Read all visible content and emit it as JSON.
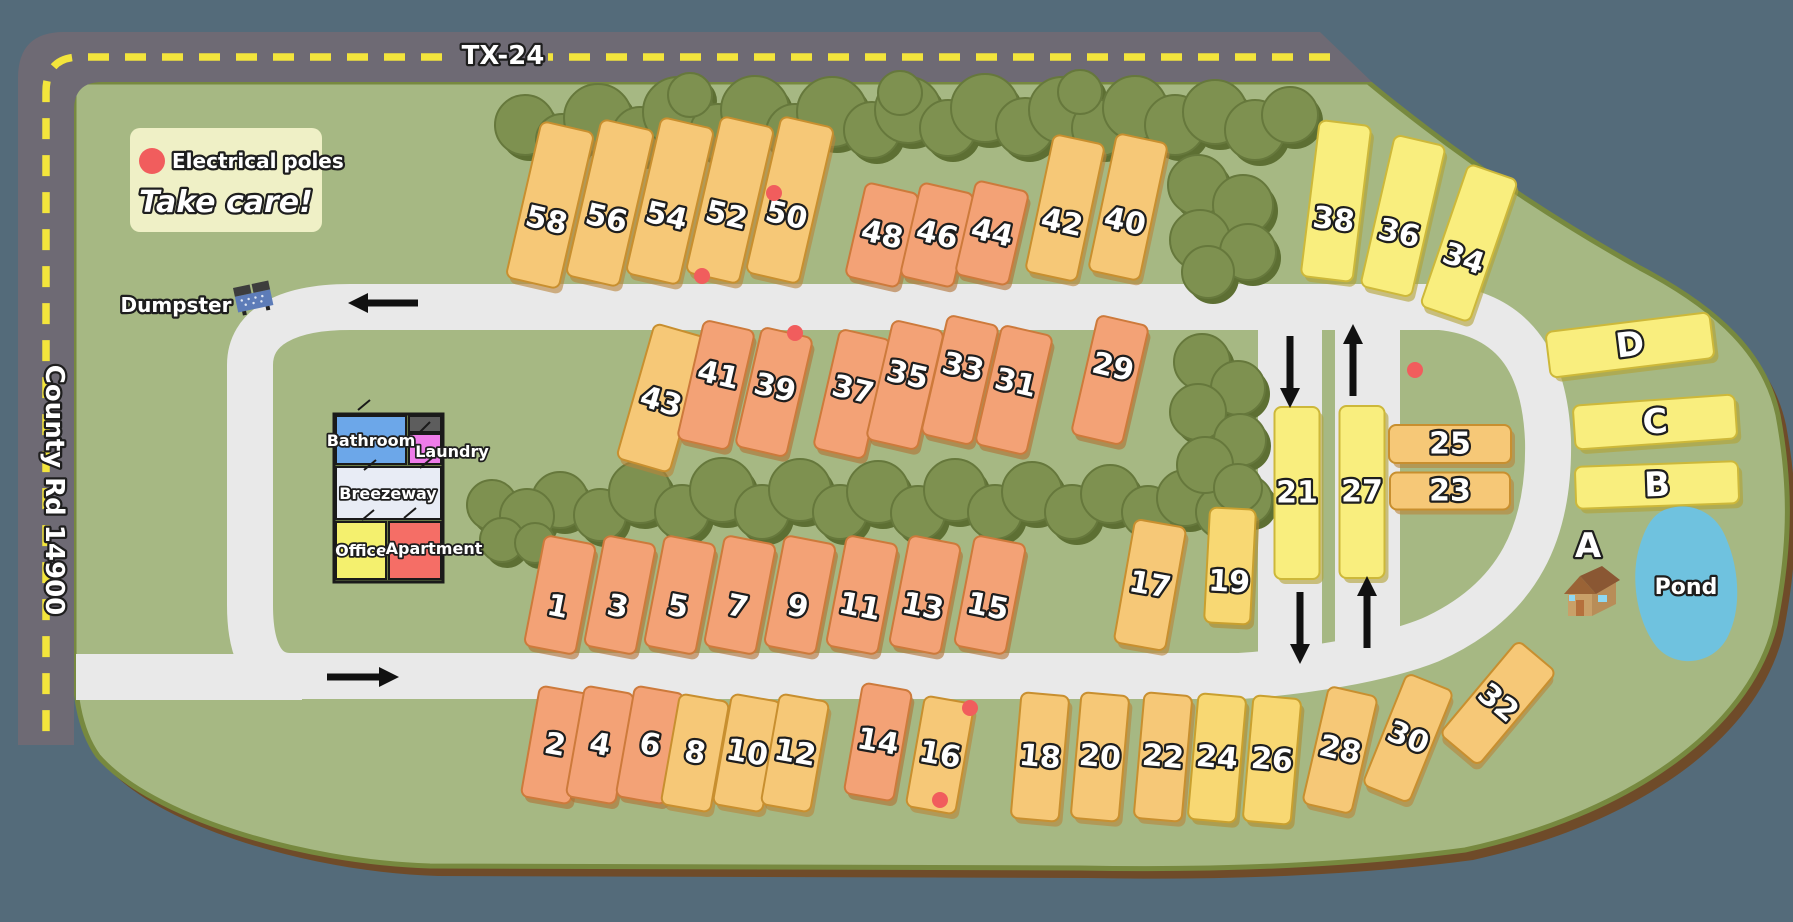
{
  "map": {
    "roads": {
      "highway": "TX-24",
      "county": "County Rd 14900"
    },
    "legend": {
      "marker": "Electrical poles",
      "warning": "Take care!"
    },
    "labels": {
      "dumpster": "Dumpster",
      "pond": "Pond",
      "cabin": "A"
    },
    "building": {
      "bathroom": "Bathroom",
      "laundry": "Laundry",
      "breezeway": "Breezeway",
      "office": "Office",
      "apartment": "Apartment"
    },
    "colors": {
      "outside": "#546b7a",
      "rim": "#6f4b29",
      "rim_edge": "#77893f",
      "grass": "#a6b883",
      "road_dark": "#6e6a74",
      "road_dash": "#f3e53c",
      "road_inner": "#e9e9e9",
      "tree": "#7e9150",
      "tree_shadow": "#5d6f33",
      "tree_edge": "#66783c",
      "pond": "#6fc2df",
      "pole_dot": "#f15d5d",
      "legend_bg": "#eff0c6",
      "arrow": "#111111",
      "text_fill": "#ffffff",
      "text_stroke": "#1e1e1e",
      "lot_orange": "#f3a276",
      "lot_orange_stroke": "#cd7a3b",
      "lot_orange_shadow": "#b06f33",
      "lot_gold": "#f6c877",
      "lot_gold_stroke": "#c88f2f",
      "lot_gold_shadow": "#b9833a",
      "lot_amber": "#f8d873",
      "lot_amber_stroke": "#c9a02f",
      "lot_amber_shadow": "#b08a2e",
      "lot_yellow": "#f9ee7e",
      "lot_yellow_stroke": "#cdb83a",
      "lot_yellow_shadow": "#b3a136",
      "room_bathroom": "#6ca7e9",
      "room_laundry": "#ee7ce9",
      "room_breezeway": "#e8ecf5",
      "room_office": "#f4f06e",
      "room_apartment": "#f56e66",
      "room_storage": "#5d5d5d",
      "dumpster_body": "#5d7cb8",
      "dumpster_lid": "#3d3d3d",
      "cabin_roof": "#8a5733",
      "cabin_roof2": "#9a6336",
      "cabin_wall": "#c9a068",
      "cabin_wall2": "#b88d58",
      "cabin_door": "#b5703c",
      "cabin_window": "#8fd8f2"
    },
    "lots": [
      [
        "58",
        550,
        205,
        54,
        160,
        13,
        "g",
        16
      ],
      [
        "56",
        610,
        203,
        54,
        160,
        13,
        "g",
        16
      ],
      [
        "54",
        670,
        201,
        54,
        160,
        13,
        "g",
        16
      ],
      [
        "52",
        730,
        200,
        54,
        160,
        13,
        "g",
        16
      ],
      [
        "50",
        790,
        200,
        54,
        160,
        13,
        "g",
        16
      ],
      [
        "48",
        882,
        235,
        54,
        96,
        13,
        "o",
        0
      ],
      [
        "46",
        937,
        235,
        54,
        96,
        13,
        "o",
        0
      ],
      [
        "44",
        992,
        233,
        54,
        96,
        13,
        "o",
        0
      ],
      [
        "42",
        1065,
        208,
        52,
        140,
        12,
        "g",
        15
      ],
      [
        "40",
        1128,
        207,
        52,
        140,
        12,
        "g",
        15
      ],
      [
        "38",
        1336,
        201,
        52,
        157,
        7,
        "y",
        19
      ],
      [
        "36",
        1403,
        216,
        52,
        155,
        13,
        "y",
        18
      ],
      [
        "34",
        1469,
        243,
        52,
        150,
        19,
        "y",
        17
      ],
      [
        "43",
        662,
        398,
        55,
        140,
        16,
        "g",
        4
      ],
      [
        "41",
        716,
        385,
        52,
        122,
        13,
        "o",
        -10
      ],
      [
        "39",
        774,
        392,
        52,
        122,
        13,
        "o",
        -4
      ],
      [
        "37",
        852,
        394,
        52,
        122,
        13,
        "o",
        -4
      ],
      [
        "35",
        905,
        385,
        52,
        122,
        13,
        "o",
        -10
      ],
      [
        "33",
        960,
        380,
        52,
        122,
        13,
        "o",
        -13
      ],
      [
        "31",
        1014,
        390,
        52,
        122,
        13,
        "o",
        -7
      ],
      [
        "29",
        1110,
        380,
        52,
        122,
        13,
        "o",
        -13
      ],
      [
        "21",
        1297,
        493,
        45,
        172,
        0,
        "y",
        0
      ],
      [
        "27",
        1362,
        492,
        45,
        172,
        0,
        "y",
        0
      ],
      [
        "25",
        1450,
        444,
        122,
        38,
        0,
        "g",
        0
      ],
      [
        "23",
        1450,
        491,
        120,
        37,
        0,
        "g",
        0
      ],
      [
        "D",
        1630,
        345,
        165,
        46,
        -7,
        "y",
        0
      ],
      [
        "C",
        1655,
        422,
        162,
        44,
        -4,
        "y",
        0
      ],
      [
        "B",
        1657,
        485,
        163,
        42,
        -2,
        "y",
        0
      ],
      [
        "1",
        560,
        595,
        52,
        112,
        11,
        "o",
        12
      ],
      [
        "3",
        620,
        595,
        52,
        112,
        11,
        "o",
        12
      ],
      [
        "5",
        680,
        595,
        52,
        112,
        11,
        "o",
        12
      ],
      [
        "7",
        740,
        595,
        52,
        112,
        11,
        "o",
        12
      ],
      [
        "9",
        800,
        595,
        52,
        112,
        11,
        "o",
        12
      ],
      [
        "11",
        862,
        595,
        52,
        112,
        11,
        "o",
        12
      ],
      [
        "13",
        925,
        595,
        52,
        112,
        11,
        "o",
        12
      ],
      [
        "15",
        990,
        595,
        52,
        112,
        11,
        "o",
        12
      ],
      [
        "17",
        1150,
        585,
        52,
        125,
        10,
        "g",
        0
      ],
      [
        "19",
        1230,
        566,
        46,
        115,
        3,
        "a",
        16
      ],
      [
        "2",
        555,
        745,
        50,
        112,
        10,
        "o",
        0
      ],
      [
        "4",
        600,
        745,
        50,
        112,
        10,
        "o",
        0
      ],
      [
        "6",
        650,
        745,
        50,
        112,
        10,
        "o",
        0
      ],
      [
        "8",
        695,
        753,
        50,
        112,
        10,
        "g",
        0
      ],
      [
        "10",
        747,
        753,
        50,
        112,
        10,
        "g",
        0
      ],
      [
        "12",
        795,
        753,
        50,
        112,
        10,
        "g",
        0
      ],
      [
        "14",
        878,
        742,
        50,
        112,
        10,
        "o",
        0
      ],
      [
        "16",
        940,
        755,
        50,
        112,
        10,
        "g",
        0
      ],
      [
        "18",
        1040,
        757,
        48,
        126,
        5,
        "g",
        0
      ],
      [
        "20",
        1100,
        757,
        48,
        126,
        5,
        "g",
        0
      ],
      [
        "22",
        1163,
        757,
        48,
        126,
        5,
        "g",
        0
      ],
      [
        "24",
        1217,
        758,
        48,
        126,
        5,
        "a",
        0
      ],
      [
        "26",
        1272,
        760,
        48,
        126,
        5,
        "a",
        0
      ],
      [
        "28",
        1340,
        750,
        50,
        120,
        13,
        "g",
        0
      ],
      [
        "30",
        1408,
        738,
        50,
        120,
        22,
        "g",
        0
      ],
      [
        "32",
        1498,
        703,
        50,
        122,
        40,
        "g",
        0
      ]
    ],
    "trees": [
      [
        525,
        125,
        30
      ],
      [
        562,
        140,
        26
      ],
      [
        598,
        118,
        34
      ],
      [
        640,
        135,
        28
      ],
      [
        678,
        112,
        35
      ],
      [
        718,
        132,
        28
      ],
      [
        755,
        110,
        34
      ],
      [
        795,
        133,
        29
      ],
      [
        832,
        112,
        35
      ],
      [
        872,
        130,
        28
      ],
      [
        908,
        110,
        33
      ],
      [
        948,
        128,
        28
      ],
      [
        985,
        108,
        34
      ],
      [
        1025,
        127,
        29
      ],
      [
        1062,
        110,
        33
      ],
      [
        1100,
        128,
        28
      ],
      [
        1135,
        108,
        32
      ],
      [
        1175,
        125,
        30
      ],
      [
        1215,
        112,
        32
      ],
      [
        1255,
        130,
        30
      ],
      [
        1290,
        115,
        28
      ],
      [
        690,
        95,
        22
      ],
      [
        900,
        93,
        22
      ],
      [
        1080,
        92,
        22
      ],
      [
        1198,
        185,
        30
      ],
      [
        1243,
        205,
        30
      ],
      [
        1200,
        240,
        30
      ],
      [
        1248,
        252,
        28
      ],
      [
        1208,
        272,
        26
      ],
      [
        560,
        500,
        28
      ],
      [
        600,
        515,
        26
      ],
      [
        640,
        492,
        31
      ],
      [
        682,
        512,
        27
      ],
      [
        722,
        490,
        32
      ],
      [
        762,
        512,
        27
      ],
      [
        800,
        490,
        31
      ],
      [
        840,
        512,
        27
      ],
      [
        878,
        492,
        31
      ],
      [
        918,
        513,
        27
      ],
      [
        955,
        490,
        31
      ],
      [
        995,
        512,
        27
      ],
      [
        1032,
        492,
        30
      ],
      [
        1072,
        512,
        27
      ],
      [
        1110,
        494,
        29
      ],
      [
        1148,
        512,
        26
      ],
      [
        1185,
        498,
        28
      ],
      [
        1222,
        512,
        26
      ],
      [
        1248,
        500,
        24
      ],
      [
        1202,
        362,
        28
      ],
      [
        1238,
        388,
        27
      ],
      [
        1198,
        412,
        28
      ],
      [
        1240,
        440,
        26
      ],
      [
        1205,
        465,
        28
      ],
      [
        1238,
        488,
        24
      ],
      [
        492,
        505,
        25
      ],
      [
        527,
        516,
        27
      ],
      [
        502,
        540,
        22
      ],
      [
        535,
        543,
        20
      ]
    ],
    "poles": [
      [
        774,
        193
      ],
      [
        702,
        276
      ],
      [
        795,
        333
      ],
      [
        1415,
        370
      ],
      [
        970,
        708
      ],
      [
        940,
        800
      ]
    ],
    "arrows": [
      [
        418,
        303,
        366,
        303
      ],
      [
        327,
        677,
        381,
        677
      ],
      [
        1290,
        336,
        1290,
        390
      ],
      [
        1353,
        396,
        1353,
        342
      ],
      [
        1300,
        592,
        1300,
        646
      ],
      [
        1367,
        648,
        1367,
        594
      ]
    ]
  }
}
